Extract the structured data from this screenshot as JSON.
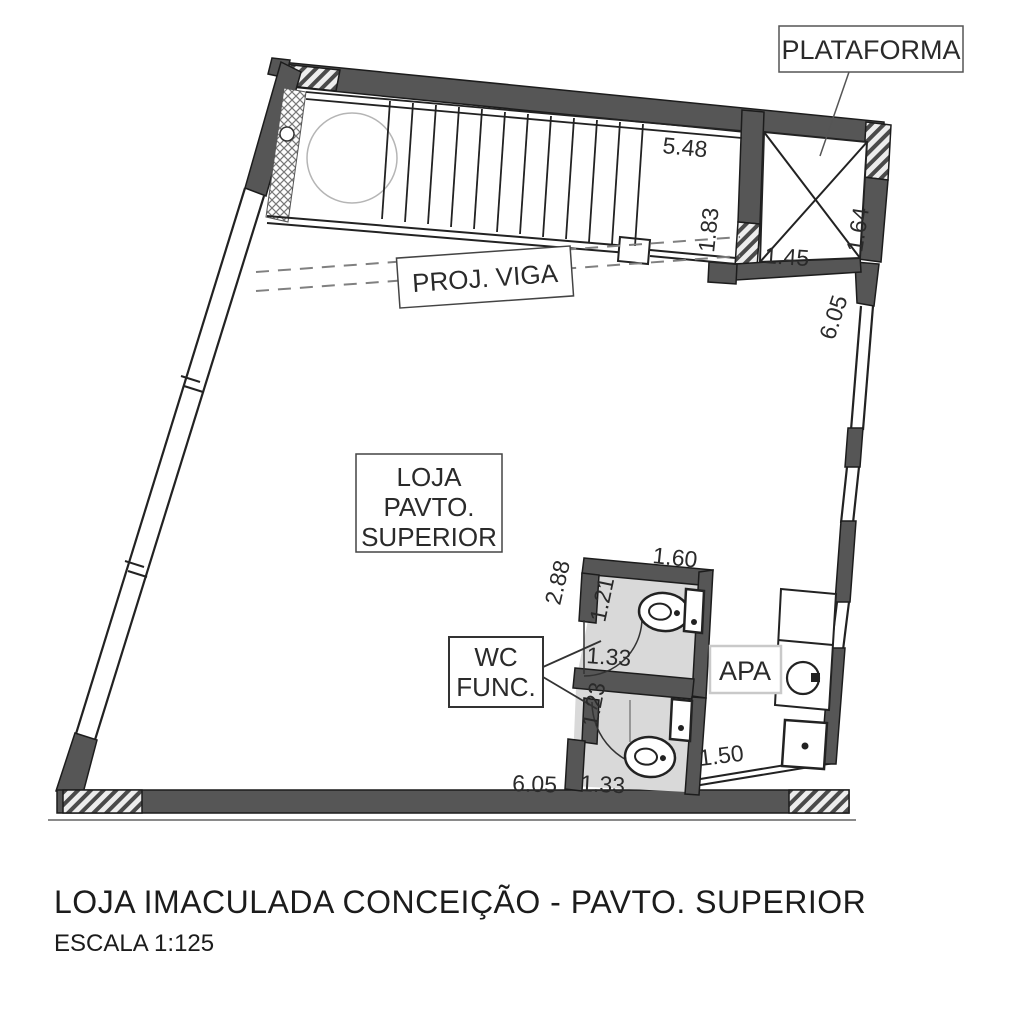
{
  "colors": {
    "wall_fill": "#565656",
    "outline": "#1c1c1c",
    "wc_fill": "#d9d9d9",
    "dim_text": "#2a2a2a",
    "light_border": "#c9c9c9",
    "dashed_beam": "#808080"
  },
  "plan": {
    "labels": {
      "plataforma": "PLATAFORMA",
      "proj_viga": "PROJ. VIGA",
      "loja": {
        "line1": "LOJA",
        "line2": "PAVTO.",
        "line3": "SUPERIOR"
      },
      "wc": {
        "line1": "WC",
        "line2": "FUNC."
      },
      "apa": "APA"
    },
    "dimensions": {
      "stair_width": "5.48",
      "stair_depth": "1.83",
      "platform_width": "1.45",
      "platform_depth": "1.64",
      "right_wall": "6.05",
      "wc_top": "1.60",
      "wc_left_height": "2.88",
      "wc1_depth": "1.21",
      "wc1_width": "1.33",
      "wc2_depth": "1.23",
      "wc2_width": "1.33",
      "apa_width": "1.50",
      "bottom": "6.05"
    }
  },
  "titleblock": {
    "title": "LOJA IMACULADA CONCEIÇÃO - PAVTO. SUPERIOR",
    "scale": "ESCALA 1:125"
  }
}
